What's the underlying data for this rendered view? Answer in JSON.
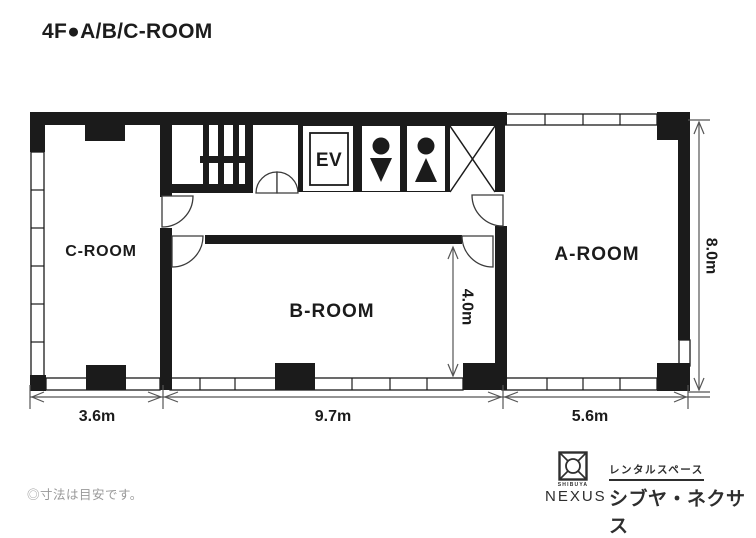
{
  "title": "4F●A/B/C-ROOM",
  "rooms": {
    "a": "A-ROOM",
    "b": "B-ROOM",
    "c": "C-ROOM"
  },
  "facilities": {
    "elevator": "EV"
  },
  "dimensions": {
    "c_width": "3.6m",
    "b_width": "9.7m",
    "a_width": "5.6m",
    "total_depth": "8.0m",
    "b_depth": "4.0m"
  },
  "note": "◎寸法は目安です。",
  "logo": {
    "shibuya": "SHIBUYA",
    "nexus": "NEXUS",
    "service_type": "レンタルスペース",
    "brand_name": "シブヤ・ネクサス"
  },
  "colors": {
    "wall": "#1b1b1b",
    "dimension_line": "#555555",
    "note_text": "#999999",
    "logo_text": "#2e2e2e"
  }
}
